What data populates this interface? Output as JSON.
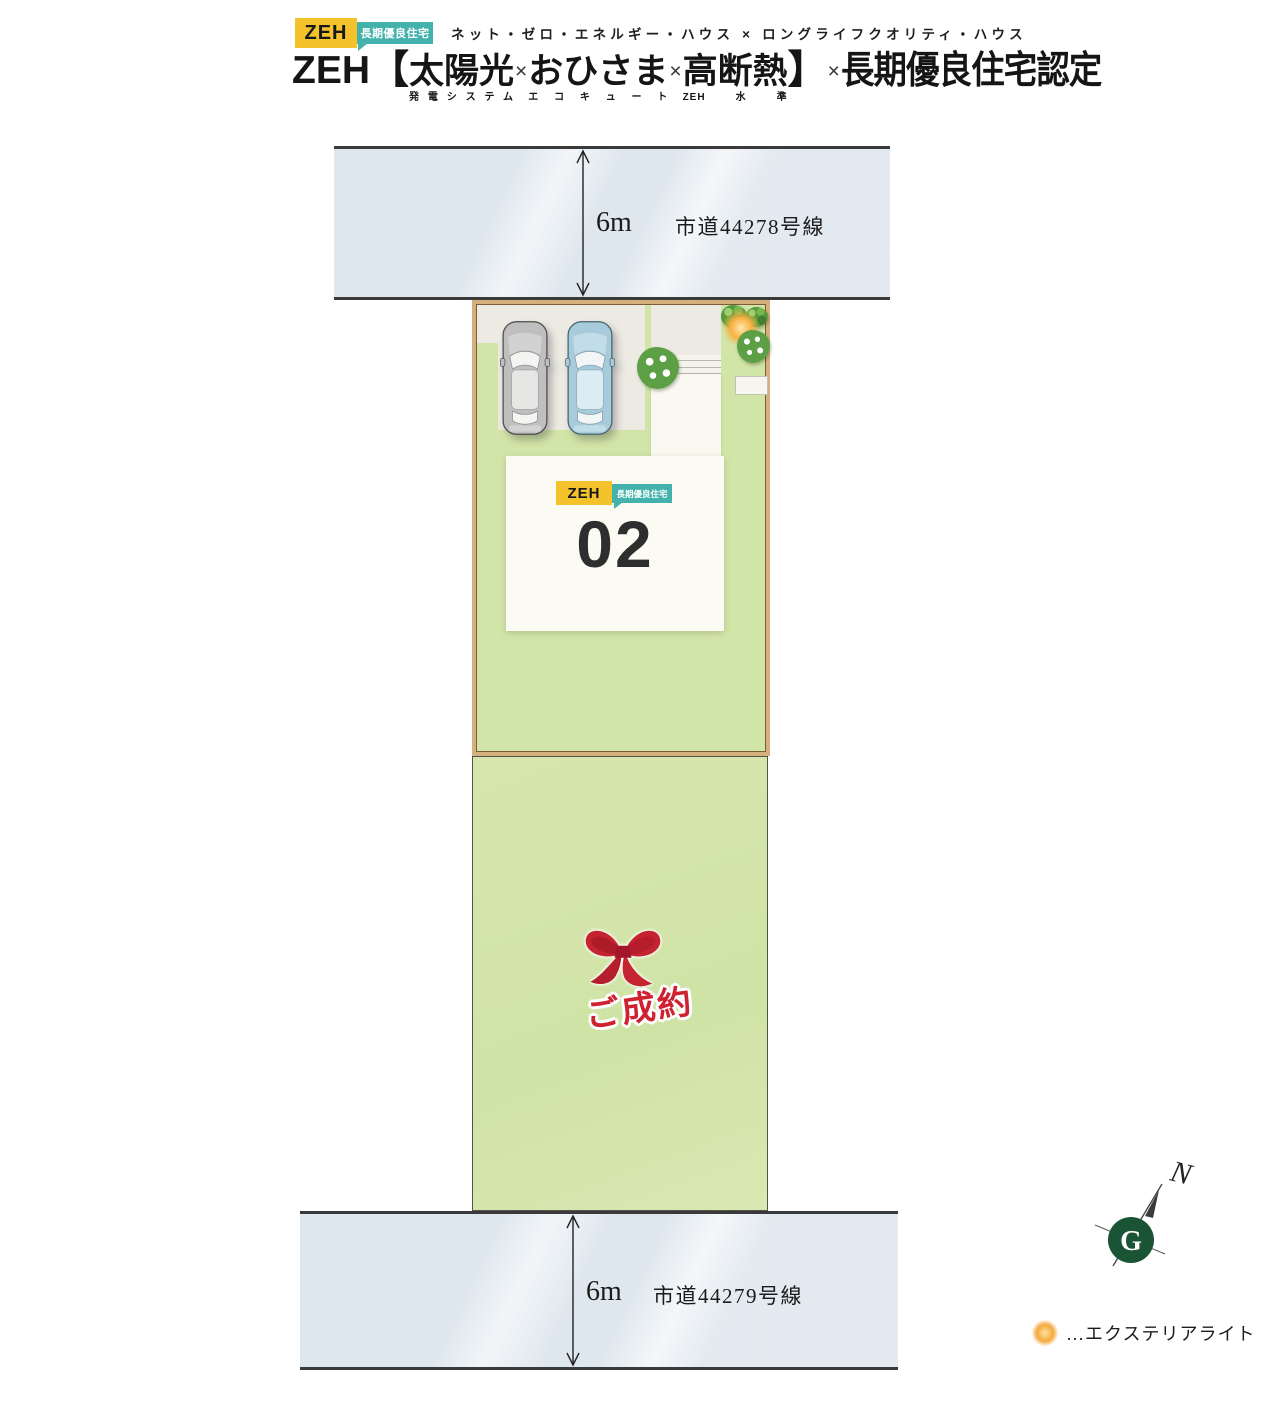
{
  "header": {
    "badge_zeh": "ZEH",
    "badge_choki": "長期優良住宅",
    "subtitle": "ネット・ゼロ・エネルギー・ハウス × ロングライフクオリティ・ハウス",
    "title_prefix": "ZEH【",
    "title_groups": [
      {
        "main": "太陽光",
        "ruby": "発電システム"
      },
      {
        "main": "おひさま",
        "ruby": "エコキュート"
      },
      {
        "main": "高断熱",
        "ruby": "ZEH水準"
      }
    ],
    "title_cross": "×",
    "title_bracket_close": "】",
    "title_suffix": "長期優良住宅認定"
  },
  "site_plan": {
    "road_top": {
      "width_label": "6m",
      "name": "市道44278号線"
    },
    "road_bottom": {
      "width_label": "6m",
      "name": "市道44279号線"
    },
    "lot_02": {
      "number": "02",
      "badge_zeh": "ZEH",
      "badge_choki": "長期優良住宅"
    },
    "lot_sold": {
      "label": "ご成約"
    },
    "compass": {
      "north": "N"
    },
    "legend": {
      "light_label": "…エクステリアライト"
    }
  },
  "colors": {
    "accent_yellow": "#f4c22b",
    "accent_teal": "#43b2ac",
    "lawn_green": "#d2e5a8",
    "road_gray": "#e8edf2",
    "lot_border_tan": "#d6b07c",
    "sold_red": "#cf2130",
    "compass_green": "#1b5434"
  }
}
